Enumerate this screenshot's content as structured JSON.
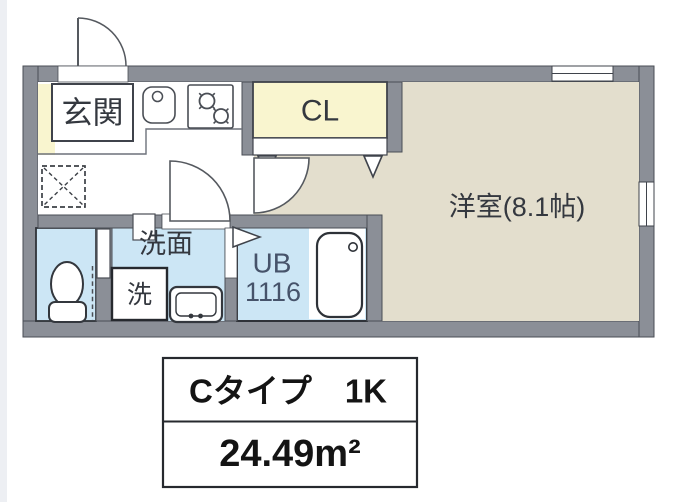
{
  "floorplan": {
    "labels": {
      "genkan": "玄関",
      "closet": "CL",
      "western_room": "洋室(8.1帖)",
      "washroom": "洗面",
      "washing_machine": "洗",
      "unit_bath": "UB",
      "unit_bath_size": "1116"
    },
    "colors": {
      "wall": "#8b8f97",
      "room_beige": "#e3decd",
      "genkan_yellow": "#f9f5cf",
      "wet_area_blue": "#cce6f5",
      "label_text": "#34383f",
      "bath_label_text": "#46536a",
      "line": "#4a4e55"
    },
    "fixtures": [
      "entrance-door",
      "kitchen-sink",
      "gas-stove",
      "refrigerator-space",
      "closet-double-doors",
      "room-door",
      "washroom-door",
      "toilet",
      "toilet-door",
      "washbasin",
      "washing-machine-space",
      "bath-folding-door",
      "bathtub",
      "window-top",
      "window-right"
    ]
  },
  "info_box": {
    "type_label": "Cタイプ　1K",
    "area_label": "24.49m²"
  }
}
